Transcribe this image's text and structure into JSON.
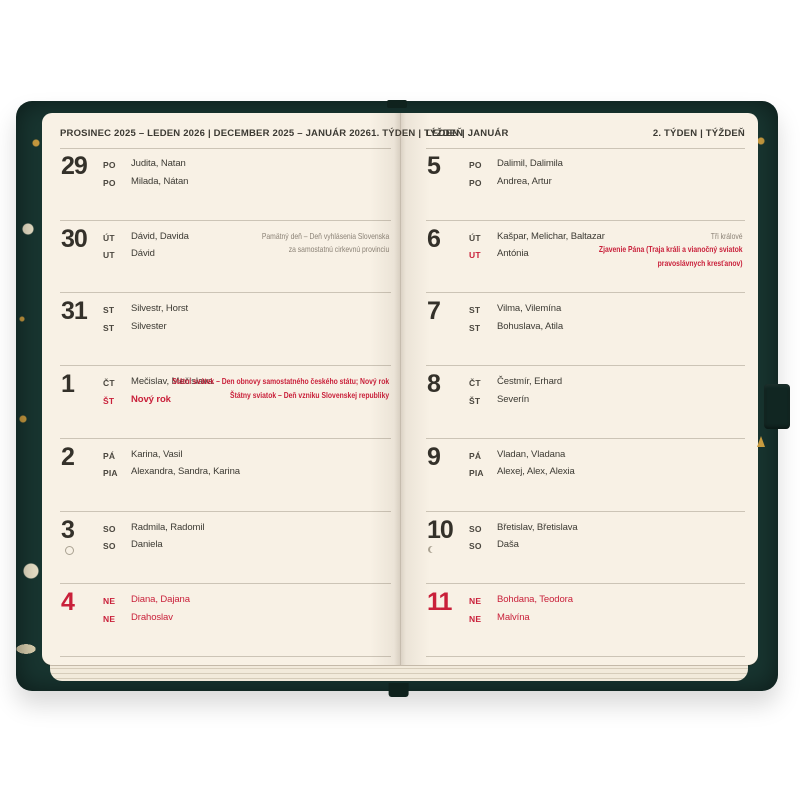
{
  "product": "weekly-diary-photo",
  "colors": {
    "paper": "#f8f1e5",
    "cover_teal": "#183530",
    "holiday_red": "#c9203a",
    "note_gray": "#8b8276",
    "grid_line": "#ccc4b6",
    "gold_accent": "#c89b3f"
  },
  "hardware": {
    "pen_loop_icon": "pen-loop",
    "bookmark_icon": "bookmark-ribbon",
    "moon_full_icon": "full-moon",
    "moon_last_quarter_icon": "last-quarter-moon"
  },
  "pages": [
    {
      "side": "left",
      "header": {
        "months": "PROSINEC 2025 – LEDEN 2026  |  DECEMBER 2025 – JANUÁR 2026",
        "week": "1. TÝDEN  |  TÝŽDEŇ"
      },
      "days": [
        {
          "num": "29",
          "red": false,
          "moon": null,
          "lines": [
            {
              "label": "PO",
              "name": "Judita, Natan"
            },
            {
              "label": "PO",
              "name": "Milada, Nátan"
            }
          ],
          "notes": []
        },
        {
          "num": "30",
          "red": false,
          "moon": null,
          "lines": [
            {
              "label": "ÚT",
              "name": "Dávid, Davida"
            },
            {
              "label": "UT",
              "name": "Dávid"
            }
          ],
          "notes": [
            {
              "red": false,
              "lines": [
                "Pamätný deň – Deň vyhlásenia Slovenska",
                "za samostatnú cirkevnú provinciu"
              ]
            }
          ]
        },
        {
          "num": "31",
          "red": false,
          "moon": null,
          "lines": [
            {
              "label": "ST",
              "name": "Silvestr, Horst"
            },
            {
              "label": "ST",
              "name": "Silvester"
            }
          ],
          "notes": []
        },
        {
          "num": "1",
          "red": false,
          "moon": null,
          "lines": [
            {
              "label": "ČT",
              "name": "Mečislav, Mečislava"
            },
            {
              "label": "ŠT",
              "name": "Nový rok",
              "label_red": true,
              "name_red": true,
              "bold": true
            }
          ],
          "notes": [
            {
              "red": true,
              "lines": [
                "Státní svátek – Den obnovy samostatného českého státu; Nový rok"
              ]
            },
            {
              "red": true,
              "lines": [
                "Štátny sviatok – Deň vzniku Slovenskej republiky"
              ]
            }
          ]
        },
        {
          "num": "2",
          "red": false,
          "moon": null,
          "lines": [
            {
              "label": "PÁ",
              "name": "Karina, Vasil"
            },
            {
              "label": "PIA",
              "name": "Alexandra, Sandra, Karina"
            }
          ],
          "notes": []
        },
        {
          "num": "3",
          "red": false,
          "moon": "full",
          "lines": [
            {
              "label": "SO",
              "name": "Radmila, Radomil"
            },
            {
              "label": "SO",
              "name": "Daniela"
            }
          ],
          "notes": []
        },
        {
          "num": "4",
          "red": true,
          "moon": null,
          "lines": [
            {
              "label": "NE",
              "name": "Diana, Dajana",
              "label_red": true,
              "name_red": true
            },
            {
              "label": "NE",
              "name": "Drahoslav",
              "label_red": true,
              "name_red": true
            }
          ],
          "notes": []
        }
      ]
    },
    {
      "side": "right",
      "header": {
        "months": "LEDEN  |  JANUÁR",
        "week": "2. TÝDEN  |  TÝŽDEŇ"
      },
      "days": [
        {
          "num": "5",
          "red": false,
          "moon": null,
          "lines": [
            {
              "label": "PO",
              "name": "Dalimil, Dalimila"
            },
            {
              "label": "PO",
              "name": "Andrea, Artur"
            }
          ],
          "notes": []
        },
        {
          "num": "6",
          "red": false,
          "moon": null,
          "lines": [
            {
              "label": "ÚT",
              "name": "Kašpar, Melichar, Baltazar"
            },
            {
              "label": "UT",
              "name": "Antónia",
              "label_red": true
            }
          ],
          "notes": [
            {
              "red": false,
              "lines": [
                "Tři králové"
              ]
            },
            {
              "red": true,
              "lines": [
                "Zjavenie Pána (Traja králi a vianočný sviatok",
                "pravoslávnych kresťanov)"
              ]
            }
          ]
        },
        {
          "num": "7",
          "red": false,
          "moon": null,
          "lines": [
            {
              "label": "ST",
              "name": "Vilma, Vilemína"
            },
            {
              "label": "ST",
              "name": "Bohuslava, Atila"
            }
          ],
          "notes": []
        },
        {
          "num": "8",
          "red": false,
          "moon": null,
          "lines": [
            {
              "label": "ČT",
              "name": "Čestmír, Erhard"
            },
            {
              "label": "ŠT",
              "name": "Severín"
            }
          ],
          "notes": []
        },
        {
          "num": "9",
          "red": false,
          "moon": null,
          "lines": [
            {
              "label": "PÁ",
              "name": "Vladan, Vladana"
            },
            {
              "label": "PIA",
              "name": "Alexej, Alex, Alexia"
            }
          ],
          "notes": []
        },
        {
          "num": "10",
          "red": false,
          "moon": "last-quarter",
          "lines": [
            {
              "label": "SO",
              "name": "Břetislav, Břetislava"
            },
            {
              "label": "SO",
              "name": "Daša"
            }
          ],
          "notes": []
        },
        {
          "num": "11",
          "red": true,
          "moon": null,
          "lines": [
            {
              "label": "NE",
              "name": "Bohdana, Teodora",
              "label_red": true,
              "name_red": true
            },
            {
              "label": "NE",
              "name": "Malvína",
              "label_red": true,
              "name_red": true
            }
          ],
          "notes": []
        }
      ]
    }
  ]
}
